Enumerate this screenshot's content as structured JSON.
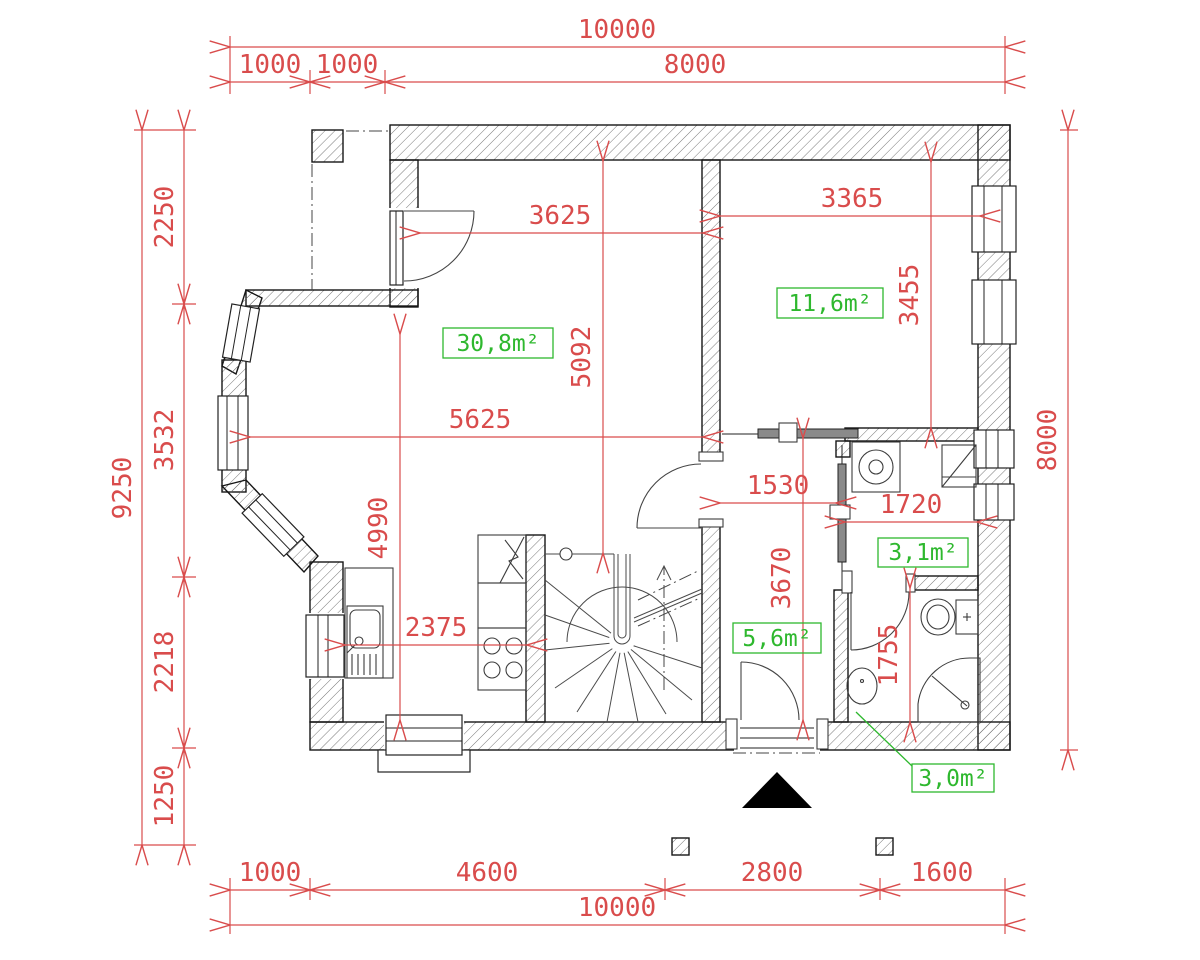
{
  "dimensions": {
    "top": {
      "total": "10000",
      "seg1": "1000",
      "seg2": "1000",
      "seg3": "8000"
    },
    "left": {
      "total": "9250",
      "seg1": "2250",
      "seg2": "3532",
      "seg3": "2218",
      "seg4": "1250"
    },
    "right": {
      "total": "8000"
    },
    "bottom": {
      "seg1": "1000",
      "seg2": "4600",
      "seg3": "2800",
      "seg4": "1600",
      "total": "10000"
    },
    "interior": {
      "living_top_width": "3625",
      "living_height": "5092",
      "living_width": "5625",
      "kitchen_height": "4990",
      "kitchen_width": "2375",
      "bedroom_width": "3365",
      "bedroom_height": "3455",
      "hall_width": "1530",
      "utility_width": "1720",
      "hall_height": "3670",
      "bath_height": "1755"
    }
  },
  "areas": {
    "living": "30,8m²",
    "bedroom": "11,6m²",
    "utility": "3,1m²",
    "hall": "5,6m²",
    "bathroom": "3,0m²"
  },
  "colors": {
    "dimension": "#d94c4c",
    "area_label": "#2eb82e",
    "wall": "#161616"
  }
}
